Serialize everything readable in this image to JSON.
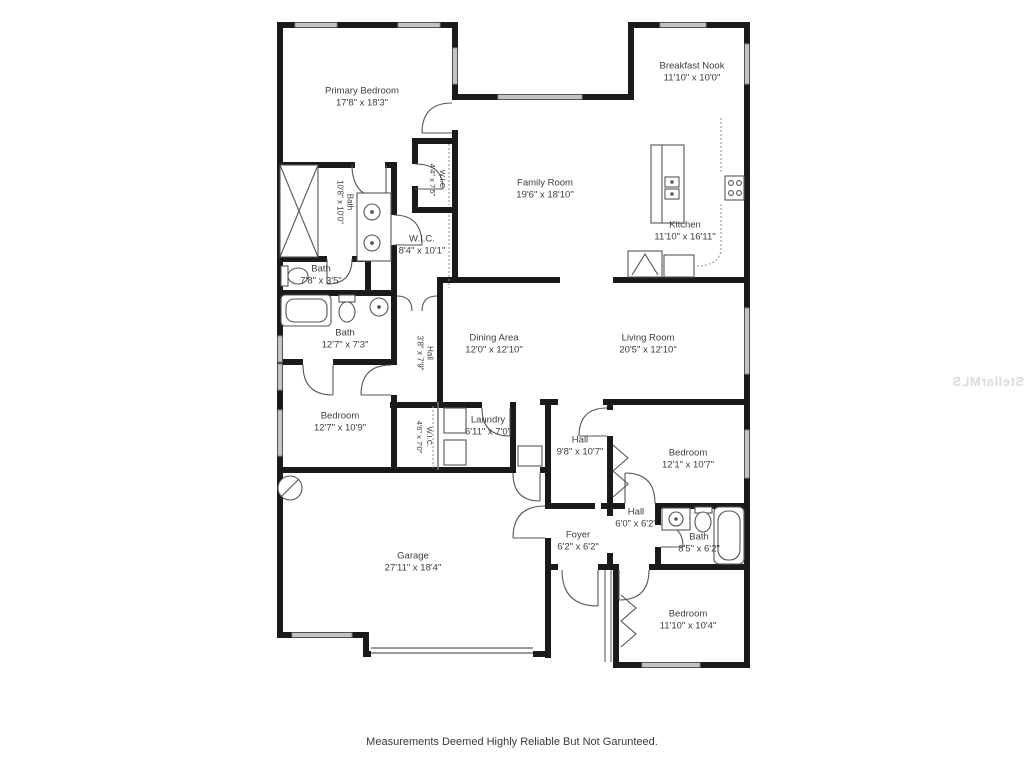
{
  "disclaimer": "Measurements Deemed Highly Reliable But Not Garunteed.",
  "watermark": "StellarMLS",
  "colors": {
    "wall": "#1a1a1a",
    "fixture": "#555555",
    "window": "#9a9a9a"
  },
  "rooms": [
    {
      "name": "Primary Bedroom",
      "dims": "17'8\" x 18'3\""
    },
    {
      "name": "Breakfast Nook",
      "dims": "11'10\" x 10'0\""
    },
    {
      "name": "Family Room",
      "dims": "19'6\" x 18'10\""
    },
    {
      "name": "Kitchen",
      "dims": "11'10\" x 16'11\""
    },
    {
      "name": "Bath",
      "dims": "10'8\" x 10'0\""
    },
    {
      "name": "W.I.C.",
      "dims": "4'4\" x 7'5\""
    },
    {
      "name": "W.I.C.",
      "dims": "8'4\" x 10'1\""
    },
    {
      "name": "Bath",
      "dims": "7'8\" x 3'5\""
    },
    {
      "name": "Bath",
      "dims": "12'7\" x 7'3\""
    },
    {
      "name": "Hall",
      "dims": "3'8\" x 7'9\""
    },
    {
      "name": "Dining Area",
      "dims": "12'0\" x 12'10\""
    },
    {
      "name": "Living Room",
      "dims": "20'5\" x 12'10\""
    },
    {
      "name": "Bedroom",
      "dims": "12'7\" x 10'9\""
    },
    {
      "name": "W.I.C.",
      "dims": "4'6\" x 7'0\""
    },
    {
      "name": "Laundry",
      "dims": "6'11\" x 7'0\""
    },
    {
      "name": "Hall",
      "dims": "9'8\" x 10'7\""
    },
    {
      "name": "Bedroom",
      "dims": "12'1\" x 10'7\""
    },
    {
      "name": "Hall",
      "dims": "6'0\" x 6'2\""
    },
    {
      "name": "Foyer",
      "dims": "6'2\" x 6'2\""
    },
    {
      "name": "Bath",
      "dims": "8'5\" x 6'2\""
    },
    {
      "name": "Garage",
      "dims": "27'11\" x 18'4\""
    },
    {
      "name": "Bedroom",
      "dims": "11'10\" x 10'4\""
    }
  ]
}
